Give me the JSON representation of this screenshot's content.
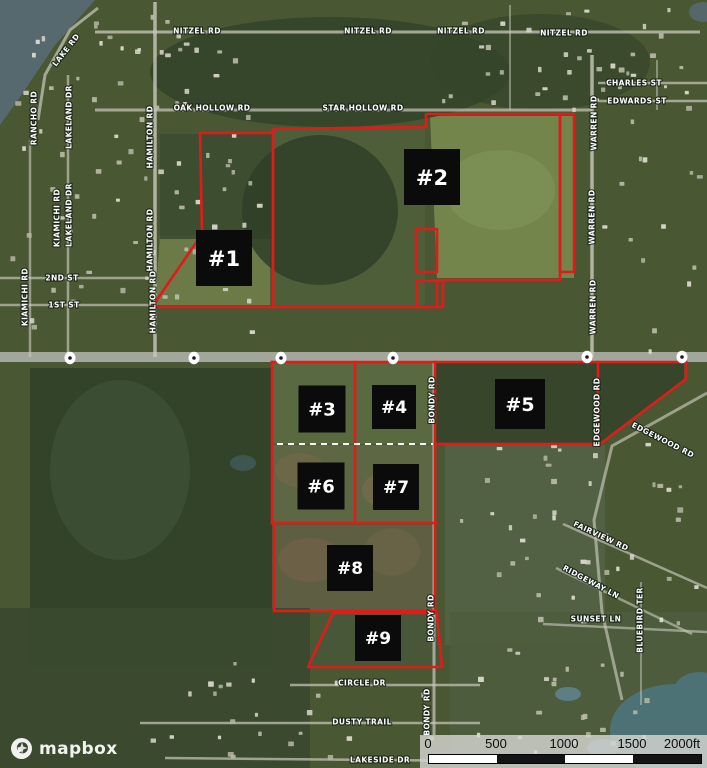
{
  "map": {
    "accent_red": "#e01c1a",
    "attribution": {
      "logo_text": "mapbox"
    },
    "scale_bar": {
      "ticks": [
        "0",
        "500",
        "1000",
        "1500",
        "2000ft"
      ],
      "segment_colors": [
        "#ffffff",
        "#141414",
        "#ffffff",
        "#141414"
      ]
    },
    "parcel_labels": [
      {
        "label": "#1",
        "x": 224,
        "y": 258,
        "size": 56
      },
      {
        "label": "#2",
        "x": 432,
        "y": 177,
        "size": 56
      },
      {
        "label": "#3",
        "x": 322,
        "y": 409,
        "size": 47
      },
      {
        "label": "#4",
        "x": 394,
        "y": 407,
        "size": 44
      },
      {
        "label": "#5",
        "x": 520,
        "y": 404,
        "size": 50
      },
      {
        "label": "#6",
        "x": 321,
        "y": 486,
        "size": 47
      },
      {
        "label": "#7",
        "x": 396,
        "y": 487,
        "size": 46
      },
      {
        "label": "#8",
        "x": 350,
        "y": 568,
        "size": 46
      },
      {
        "label": "#9",
        "x": 378,
        "y": 638,
        "size": 46
      }
    ],
    "parcel_shapes": {
      "polygons": [
        {
          "points": "200,133 273,133 273,307 152,307 202,234"
        },
        {
          "points": "273,129 426,127 426,114 560,114 560,280 437,280 437,307 273,307"
        },
        {
          "points": "560,114 574,114 574,272 560,272"
        },
        {
          "points": "416,229 437,229 437,272 416,272"
        },
        {
          "points": "417,281 443,281 443,307 417,307"
        },
        {
          "points": "333,613 437,613 442,667 308,667"
        }
      ],
      "lines": [
        [
          272,
          362,
          686,
          362
        ],
        [
          686,
          362,
          686,
          379
        ],
        [
          686,
          379,
          600,
          444
        ],
        [
          600,
          444,
          435,
          444
        ],
        [
          598,
          362,
          598,
          444
        ],
        [
          272,
          362,
          272,
          523
        ],
        [
          355,
          362,
          355,
          523
        ],
        [
          435,
          362,
          435,
          613
        ],
        [
          272,
          523,
          436,
          523
        ],
        [
          274,
          524,
          274,
          611
        ],
        [
          274,
          611,
          436,
          611
        ]
      ],
      "dashed_line": [
        277,
        444,
        433,
        444
      ]
    },
    "road_labels": [
      {
        "text": "NITZEL RD",
        "x": 197,
        "y": 31,
        "rot": 0
      },
      {
        "text": "NITZEL RD",
        "x": 368,
        "y": 31,
        "rot": 0
      },
      {
        "text": "NITZEL RD",
        "x": 461,
        "y": 31,
        "rot": 0
      },
      {
        "text": "NITZEL RD",
        "x": 564,
        "y": 33,
        "rot": 0
      },
      {
        "text": "CHARLES ST",
        "x": 634,
        "y": 83,
        "rot": 0
      },
      {
        "text": "EDWARDS ST",
        "x": 637,
        "y": 101,
        "rot": 0
      },
      {
        "text": "OAK HOLLOW RD",
        "x": 212,
        "y": 108,
        "rot": 0
      },
      {
        "text": "STAR HOLLOW RD",
        "x": 363,
        "y": 108,
        "rot": 0
      },
      {
        "text": "2ND ST",
        "x": 62,
        "y": 278,
        "rot": 0
      },
      {
        "text": "1ST ST",
        "x": 64,
        "y": 305,
        "rot": 0
      },
      {
        "text": "LAKE RD",
        "x": 66,
        "y": 50,
        "rot": -52
      },
      {
        "text": "RANCHO RD",
        "x": 34,
        "y": 118,
        "rot": -90
      },
      {
        "text": "LAKELAND DR",
        "x": 69,
        "y": 117,
        "rot": -90
      },
      {
        "text": "KIAMICHI RD",
        "x": 57,
        "y": 218,
        "rot": -90
      },
      {
        "text": "LAKELAND DR",
        "x": 69,
        "y": 215,
        "rot": -90
      },
      {
        "text": "KIAMICHI RD",
        "x": 25,
        "y": 297,
        "rot": -90
      },
      {
        "text": "HAMILTON RD",
        "x": 150,
        "y": 137,
        "rot": -90
      },
      {
        "text": "HAMILTON RD",
        "x": 150,
        "y": 240,
        "rot": -90
      },
      {
        "text": "HAMILTON RD",
        "x": 153,
        "y": 302,
        "rot": -90
      },
      {
        "text": "WARREN RD",
        "x": 594,
        "y": 123,
        "rot": -90
      },
      {
        "text": "WARREN RD",
        "x": 592,
        "y": 217,
        "rot": -90
      },
      {
        "text": "WARREN RD",
        "x": 593,
        "y": 307,
        "rot": -90
      },
      {
        "text": "BONDY RD",
        "x": 432,
        "y": 400,
        "rot": -90
      },
      {
        "text": "BONDY RD",
        "x": 431,
        "y": 618,
        "rot": -90
      },
      {
        "text": "BONDY RD",
        "x": 427,
        "y": 712,
        "rot": -90
      },
      {
        "text": "EDGEWOOD RD",
        "x": 597,
        "y": 412,
        "rot": -90
      },
      {
        "text": "EDGEWOOD RD",
        "x": 663,
        "y": 440,
        "rot": 27
      },
      {
        "text": "FAIRVIEW RD",
        "x": 601,
        "y": 536,
        "rot": 25
      },
      {
        "text": "RIDGEWAY LN",
        "x": 591,
        "y": 582,
        "rot": 28
      },
      {
        "text": "SUNSET LN",
        "x": 596,
        "y": 619,
        "rot": 0
      },
      {
        "text": "BLUEBIRD TER",
        "x": 640,
        "y": 620,
        "rot": -90
      },
      {
        "text": "CIRCLE DR",
        "x": 362,
        "y": 683,
        "rot": 0
      },
      {
        "text": "DUSTY TRAIL",
        "x": 362,
        "y": 722,
        "rot": 0
      },
      {
        "text": "LAKESIDE DR",
        "x": 380,
        "y": 760,
        "rot": 0
      }
    ],
    "route_markers": [
      {
        "x": 70,
        "y": 358
      },
      {
        "x": 194,
        "y": 358
      },
      {
        "x": 281,
        "y": 358
      },
      {
        "x": 393,
        "y": 358
      },
      {
        "x": 587,
        "y": 357
      },
      {
        "x": 682,
        "y": 357
      }
    ]
  }
}
